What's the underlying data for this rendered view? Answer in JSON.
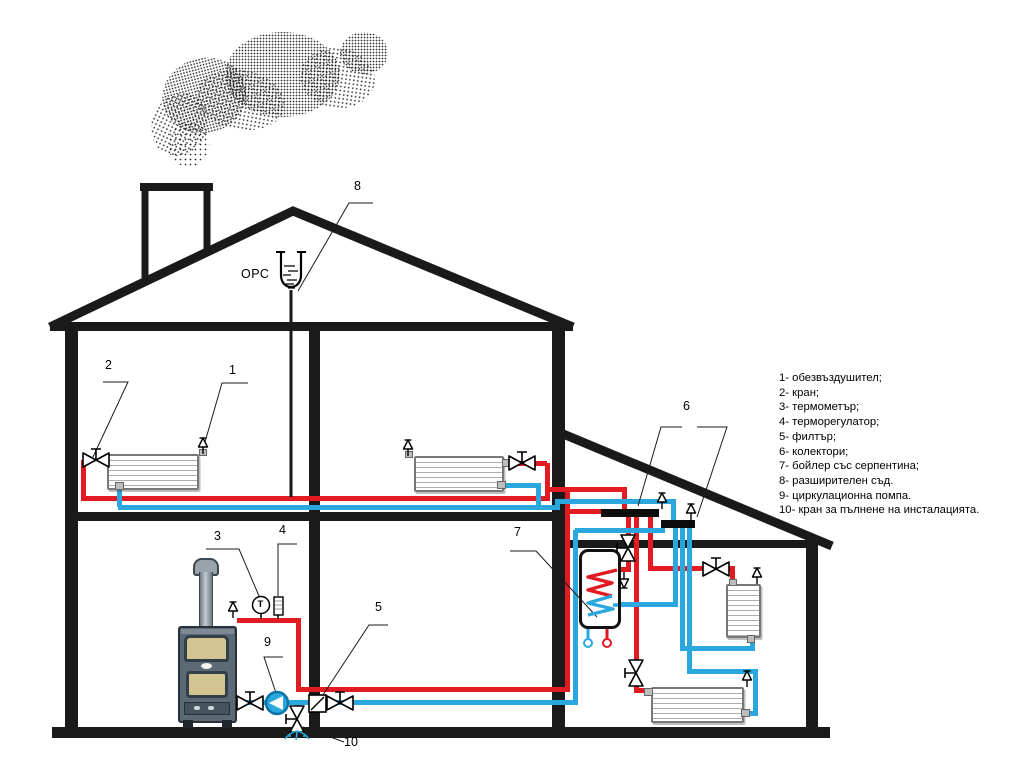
{
  "expansion_vessel_label": "ОРС",
  "thermometer_letter": "Т",
  "callouts": [
    "1",
    "2",
    "3",
    "4",
    "5",
    "6",
    "7",
    "8",
    "9",
    "10"
  ],
  "legend": {
    "items": [
      "1- обезвъздушител;",
      "2- кран;",
      "3- термометър;",
      "4- терморегулатор;",
      "5- филтър;",
      "6- колектори;",
      "7- бойлер със серпентина;",
      "8- разширителен съд.",
      "9- циркулационна помпа.",
      "10- кран за пълнене на инсталацията."
    ]
  },
  "colors": {
    "supply_pipe": "#e21b22",
    "return_pipe": "#2aa7de",
    "structure": "#1a1a1a",
    "pump_fill": "#2aa7de"
  }
}
